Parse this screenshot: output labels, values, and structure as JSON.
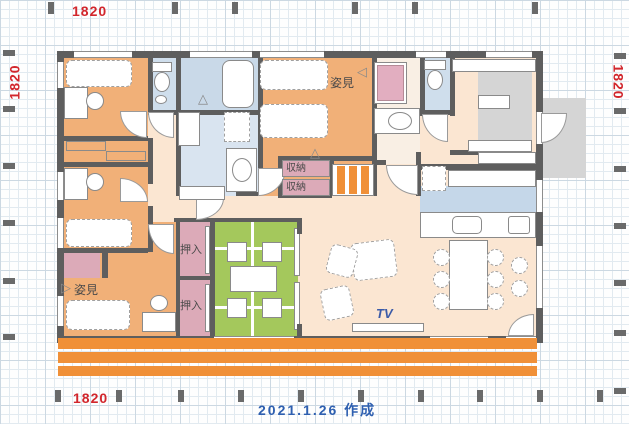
{
  "dimensions": {
    "top": "1820",
    "bottom": "1820",
    "left": "1820",
    "right": "1820"
  },
  "footer": {
    "date_note": "2021.1.26  作成"
  },
  "labels": {
    "mirror_main": "姿見",
    "mirror_west": "姿見",
    "storage_upper": "収納",
    "storage_lower": "収納",
    "closet_upper": "押入",
    "closet_lower": "押入",
    "tv": "TV"
  },
  "colors": {
    "bedroom_orange": "#f1b078",
    "hall_cream": "#fbe6d2",
    "tatami_green": "#a4c85c",
    "bath_blue": "#c9d9e8",
    "kitchen_blue": "#c5d7e9",
    "closet_pink": "#dcaab8",
    "entrance_gray": "#d5d5d5",
    "deck_orange": "#f09038",
    "wall_gray": "#5e5e5e",
    "dimension_red": "#d2262c",
    "note_blue": "#2e5fb0"
  }
}
